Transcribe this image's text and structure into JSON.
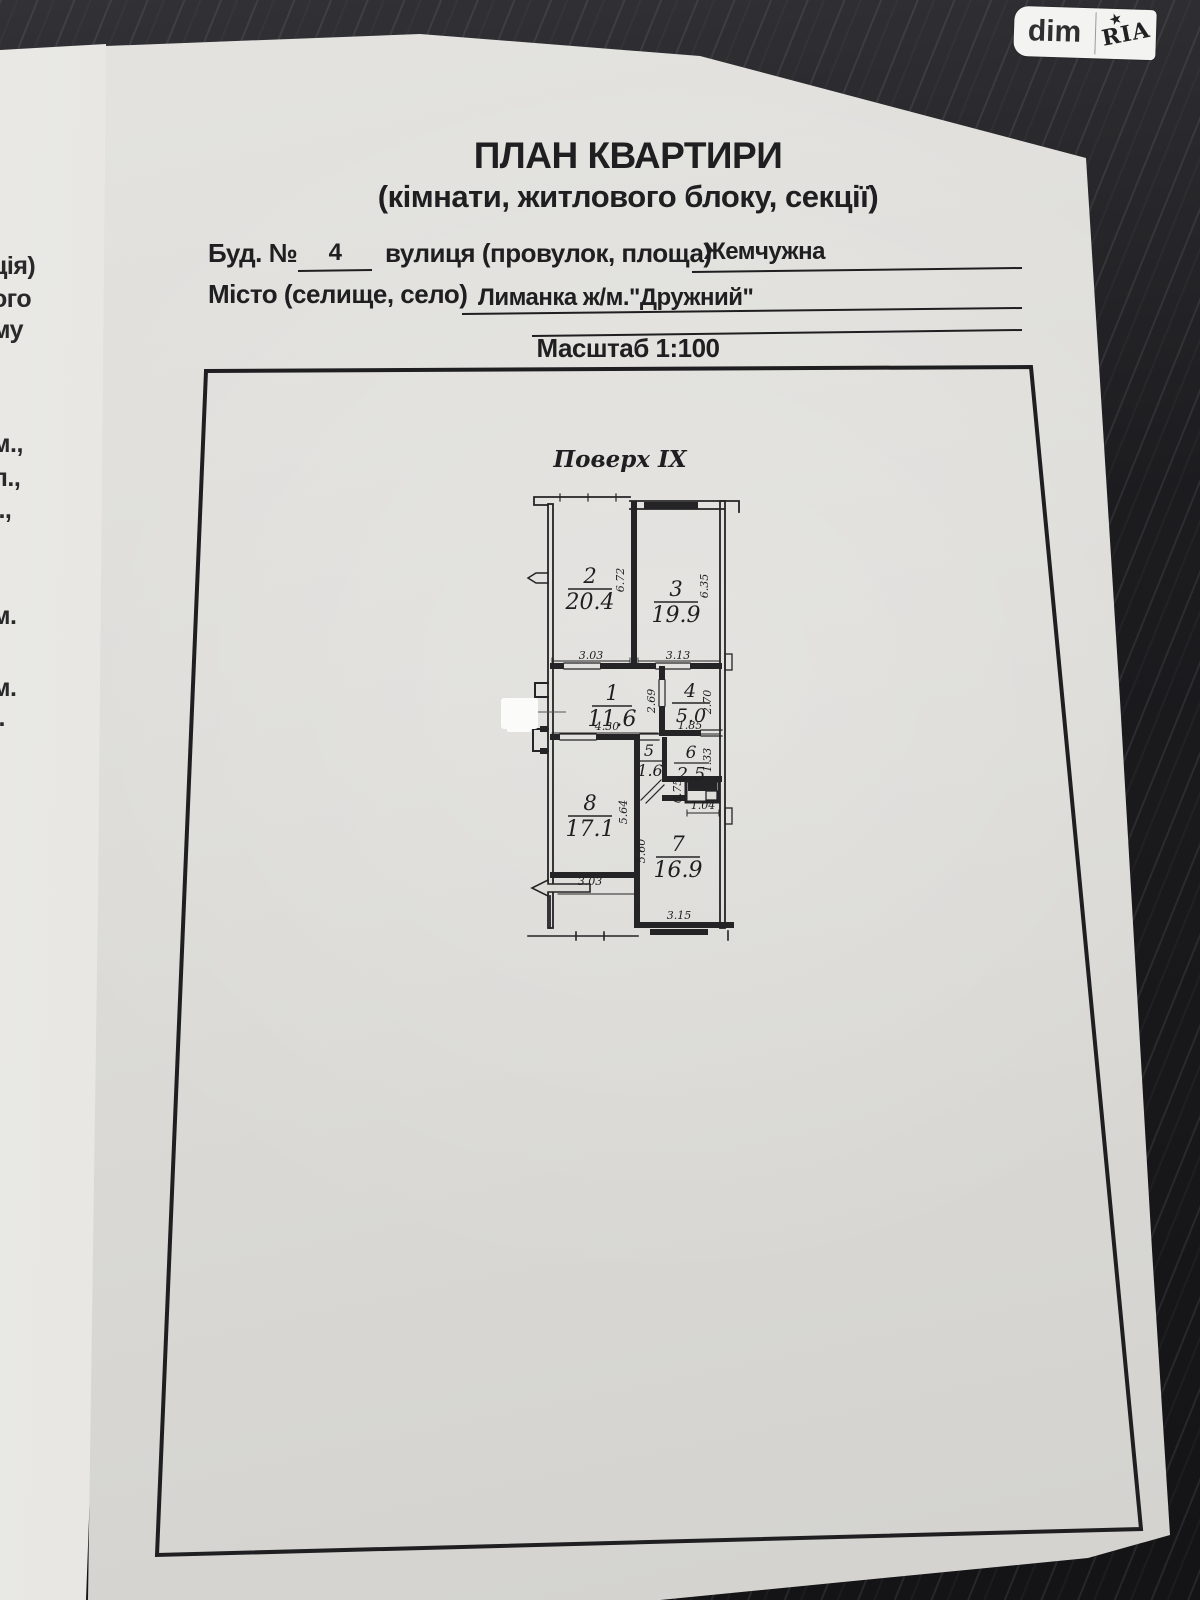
{
  "watermark": {
    "dim": "dim",
    "ria": "RIA"
  },
  "left_page_fragments": [
    "ція)",
    "ого",
    "му",
    "м.,",
    "л.,",
    "і.,",
    "м.",
    "м.",
    "і.",
    "."
  ],
  "page": {
    "title": "ПЛАН КВАРТИРИ",
    "subtitle": "(кімнати, житлового блоку, секції)",
    "form": {
      "building_label": "Буд. №",
      "building_value": "4",
      "street_label": "вулиця (провулок, площа)",
      "street_value": "Жемчужна",
      "city_label": "Місто (селище, село)",
      "city_value": "Лиманка ж/м.\"Дружний\"",
      "scale": "Масштаб 1:100"
    },
    "floor_label": "Поверх IX"
  },
  "plan": {
    "rooms": [
      {
        "number": "2",
        "area": "20.4"
      },
      {
        "number": "3",
        "area": "19.9"
      },
      {
        "number": "1",
        "area": "11.6"
      },
      {
        "number": "4",
        "area": "5.0"
      },
      {
        "number": "5",
        "area": "1.6"
      },
      {
        "number": "6",
        "area": "2.5"
      },
      {
        "number": "8",
        "area": "17.1"
      },
      {
        "number": "7",
        "area": "16.9"
      }
    ],
    "dims": {
      "room2_width": "3.03",
      "room3_width": "3.13",
      "room2_height": "6.72",
      "room3_height": "6.35",
      "room1_width": "4.30",
      "room1_height": "2.69",
      "room4_width": "1.85",
      "room4_height": "2.70",
      "room6_height": "1.33",
      "shaft_height": "0.75",
      "shaft_width": "1.04",
      "room8_height": "5.64",
      "room7_height": "5.60",
      "room8_width": "3.03",
      "room7_width": "3.15"
    }
  },
  "colors": {
    "desk": "#1c1c1f",
    "paper": "#dddcd8",
    "ink": "#1f1f21",
    "redaction": "#fbfbfa"
  }
}
